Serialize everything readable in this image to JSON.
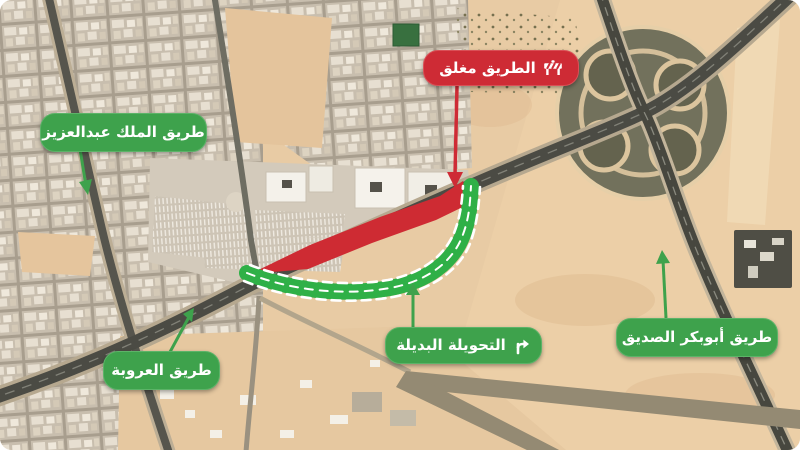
{
  "map": {
    "title": "road-closure-satellite-map",
    "badges": {
      "road_closed": {
        "label": "الطريق مغلق",
        "icon": "barrier-icon",
        "color": "#ce2b35"
      },
      "king_abdulaziz": {
        "label": "طريق الملك عبدالعزيز",
        "color": "#3ea24c"
      },
      "urubah": {
        "label": "طريق العروبة",
        "color": "#3ea24c"
      },
      "detour": {
        "label": "التحويلة البديلة",
        "icon": "detour-arrow-icon",
        "color": "#3ea24c"
      },
      "abubakr": {
        "label": "طريق أبوبكر الصديق",
        "color": "#3ea24c"
      }
    },
    "features": {
      "closed_segment_color": "#ce2b33",
      "detour_path_color": "#2fb047",
      "detour_path_style": "green band with white dashed edges and center line",
      "sand_color": "#e8cba4"
    }
  }
}
